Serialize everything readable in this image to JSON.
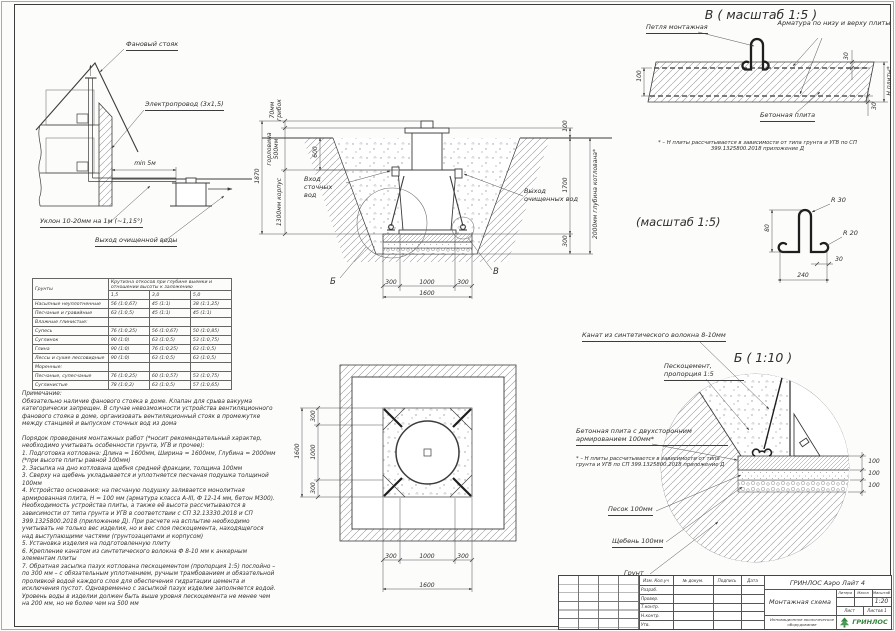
{
  "accent_colors": {
    "line": "#3c3c3c",
    "brand_green": "#35853f"
  },
  "house": {
    "label_vent_stack": "Фановый стояк",
    "label_electric": "Электропровод (3х1,5)",
    "label_distance": "min 5м",
    "label_slope": "Уклон 10-20мм на 1м (~1,15°)",
    "label_outlet": "Выход очищенной воды"
  },
  "soil_table": {
    "col_soil": "Грунты",
    "col_group": "Крутизна откосов при глубине выемки и отношении высоты к заложению",
    "depths": [
      "1,5",
      "3,0",
      "5,0"
    ],
    "rows": [
      {
        "name": "Насыпные неуплотненные",
        "v1": "56 (1:0,67)",
        "v2": "45 (1:1)",
        "v3": "38 (1:1,25)"
      },
      {
        "name": "Песчаные и гравийные",
        "v1": "63 (1:0,5)",
        "v2": "45 (1:1)",
        "v3": "45 (1:1)"
      },
      {
        "name": "Влажные глинистые:",
        "v1": "",
        "v2": "",
        "v3": ""
      },
      {
        "name": "Супесь",
        "v1": "76 (1:0,25)",
        "v2": "56 (1:0,67)",
        "v3": "50 (1:0,85)"
      },
      {
        "name": "Суглинок",
        "v1": "90 (1:0)",
        "v2": "63 (1:0,5)",
        "v3": "53 (1:0,75)"
      },
      {
        "name": "Глина",
        "v1": "90 (1:0)",
        "v2": "76 (1:0,25)",
        "v3": "63 (1:0,5)"
      },
      {
        "name": "Лессы и сухие лессовидные",
        "v1": "90 (1:0)",
        "v2": "63 (1:0,5)",
        "v3": "63 (1:0,5)"
      },
      {
        "name": "Моренные:",
        "v1": "",
        "v2": "",
        "v3": ""
      },
      {
        "name": "Песчаные, супесчаные",
        "v1": "76 (1:0,25)",
        "v2": "60 (1:0,57)",
        "v3": "53 (1:0,75)"
      },
      {
        "name": "Суглинистые",
        "v1": "78 (1:0,2)",
        "v2": "63 (1:0,5)",
        "v3": "57 (1:0,65)"
      }
    ]
  },
  "notes": {
    "note_title": "Примечание:",
    "note_body": "Обязательно наличие фанового стояка в доме. Клапан для срыва вакуума категорически запрещен. В случае невозможности устройства вентиляционного фанового стояка в доме, организовать вентиляционный стояк в промежутке между станцией и выпуском сточных вод из дома",
    "order_title": "Порядок проведения монтажных работ (*носит рекомендательный характер, необходимо учитывать особенности грунта, УГВ и прочее):",
    "steps": [
      "1. Подготовка котлована: Длина = 1600мм, Ширина = 1600мм, Глубина = 2000мм (*при высоте плиты равной 100мм)",
      "2. Засыпка на дно котлована щебня средней фракции, толщина 100мм",
      "3. Сверху на щебень укладывается и уплотняется песчаная подушка толщиной 100мм",
      "4. Устройство основания: на песчаную подушку заливается монолитная армированная плита, Н = 100 мм (арматура класса А-III, Ф 12-14 мм, бетон М300). Необходимость устройства плиты, а также её высота рассчитываются в зависимости от типа грунта и УГВ в соответствии с СП 32.13330.2018 и СП 399.1325800.2018 (приложение Д). При расчете на всплытие необходимо учитывать не только вес изделия, но и вес слоя пескоцемента, находящегося над выступающими частями (грунтозацепами и корпусом)",
      "5. Установка изделия на подготовленную плиту",
      "6. Крепление канатом из синтетического волокна Ф 8-10 мм к анкерным элементам плиты",
      "7. Обратная засыпка пазух котлована пескоцементом (пропорция 1:5) послойно – по 300 мм – с обязательным уплотнением, ручным трамбованием и обязательной проливкой водой каждого слоя для обеспечения гидратации цемента и исключения пустот. Одновременно с засыпкой пазух изделие заполняется водой. Уровень воды в изделии должен быть выше уровня пескоцемента не менее чем на 200 мм, но не более чем на 500 мм"
    ]
  },
  "section": {
    "dim_cap": "70мм грибок",
    "dim_neck": "горловина 500мм",
    "dim_total": "1870",
    "dim_body": "1300мм корпус",
    "dim_600": "600",
    "dim_100": "100",
    "dim_1700": "1700",
    "dim_300": "300",
    "dim_depth": "2000мм глубина котлована*",
    "label_inlet": "Вход сточных вод",
    "label_outlet": "Выход очищенных вод",
    "dims_bottom": [
      "300",
      "1000",
      "300"
    ],
    "dim_width_total": "1600",
    "marker_b": "Б",
    "marker_v": "В"
  },
  "plan": {
    "dims_h": [
      "300",
      "1000",
      "300"
    ],
    "dim_h_total": "1600",
    "dims_v": [
      "300",
      "1000",
      "300"
    ],
    "dim_v_total": "1600"
  },
  "detail_v": {
    "title": "В ( масштаб 1:5 )",
    "label_loop": "Петля монтажная",
    "label_rebar": "Арматура по низу и верху плиты",
    "label_slab": "Бетонная плита",
    "dim_100": "100",
    "dim_30_top": "30",
    "dim_30_bottom": "30",
    "dim_h": "Н плиты*",
    "note": "* – Н плиты рассчитывается в зависимости от типа грунта и УГВ по СП 399.1325800.2018 приложение Д"
  },
  "loop_detail": {
    "title": "(масштаб 1:5)",
    "r30": "R 30",
    "r20": "R 20",
    "dim_80": "80",
    "dim_30": "30",
    "dim_240": "240"
  },
  "detail_b": {
    "title": "Б ( 1:10 )",
    "label_rope": "Канат из синтетического волокна 8-10мм",
    "label_sandcement": "Пескоцемент, пропорция 1:5",
    "label_slab": "Бетонная плита с двухсторонним армированием 100мм*",
    "note": "* – Н плиты рассчитывается в зависимости от типа грунта и УГВ по СП 399.1325800.2018 приложение Д",
    "label_sand": "Песок 100мм",
    "label_gravel": "Щебень 100мм",
    "label_soil": "Грунт",
    "dims": [
      "100",
      "100",
      "100"
    ]
  },
  "title_block": {
    "doc_title": "ГРИНЛОС Аэро Лайт 4",
    "drawing_name": "Монтажная схема",
    "header_cells": [
      "Изм. Кол.уч",
      "№ докум.",
      "Подпись",
      "Дата"
    ],
    "rows": [
      "Разраб.",
      "Провер.",
      "Т.контр.",
      "Н.контр.",
      "Утв."
    ],
    "litera_label": "Литера",
    "massa_label": "Масса",
    "scale_label": "Масштаб",
    "scale": "1:20",
    "sheet_label": "Лист",
    "sheets_label": "Листов 1",
    "slogan": "Инновационное экологическое оборудование",
    "brand": "ГРИНЛОС"
  }
}
